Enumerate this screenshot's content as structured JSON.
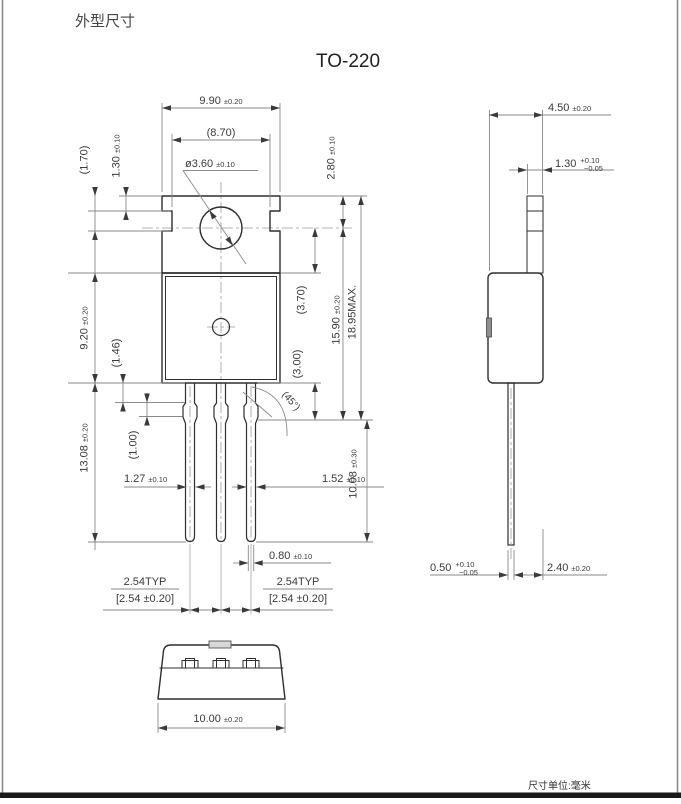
{
  "colors": {
    "object_line": "#2e2e2e",
    "dimension_line": "#8a8a8a",
    "text": "#3a3a3a",
    "page_border": "#1a1a1a"
  },
  "page": {
    "title": "外型尺寸",
    "subtitle": "TO-220",
    "unit_note": "尺寸单位:毫米"
  },
  "front": {
    "w990": {
      "v": "9.90",
      "t": "±0.20"
    },
    "w870": {
      "v": "(8.70)"
    },
    "hole": {
      "v": "ø3.60",
      "t": "±0.10"
    },
    "h170": {
      "v": "(1.70)"
    },
    "h130": {
      "v": "1.30",
      "t": "±0.10"
    },
    "h920": {
      "v": "9.20",
      "t": "±0.20"
    },
    "h146": {
      "v": "(1.46)"
    },
    "h100": {
      "v": "(1.00)"
    },
    "h1308": {
      "v": "13.08",
      "t": "±0.20"
    },
    "w127": {
      "v": "1.27",
      "t": "±0.10"
    },
    "w152": {
      "v": "1.52",
      "t": "±0.10"
    },
    "w080": {
      "v": "0.80",
      "t": "±0.10"
    },
    "h280": {
      "v": "2.80",
      "t": "±0.10"
    },
    "h370": {
      "v": "(3.70)"
    },
    "h300": {
      "v": "(3.00)"
    },
    "h1590": {
      "v": "15.90",
      "t": "±0.20"
    },
    "h1895": {
      "v": "18.95MAX."
    },
    "h1008": {
      "v": "10.08",
      "t": "±0.30"
    },
    "angle": {
      "v": "(45°)"
    },
    "pitch_left": {
      "top": "2.54TYP",
      "bottom": "[2.54 ±0.20]"
    },
    "pitch_right": {
      "top": "2.54TYP",
      "bottom": "[2.54 ±0.20]"
    }
  },
  "side": {
    "w450": {
      "v": "4.50",
      "t": "±0.20"
    },
    "t130": {
      "v": "1.30",
      "tp": "+0.10",
      "tm": "−0.05"
    },
    "t050": {
      "v": "0.50",
      "tp": "+0.10",
      "tm": "−0.05"
    },
    "w240": {
      "v": "2.40",
      "t": "±0.20"
    }
  },
  "bottom": {
    "w1000": {
      "v": "10.00",
      "t": "±0.20"
    }
  }
}
